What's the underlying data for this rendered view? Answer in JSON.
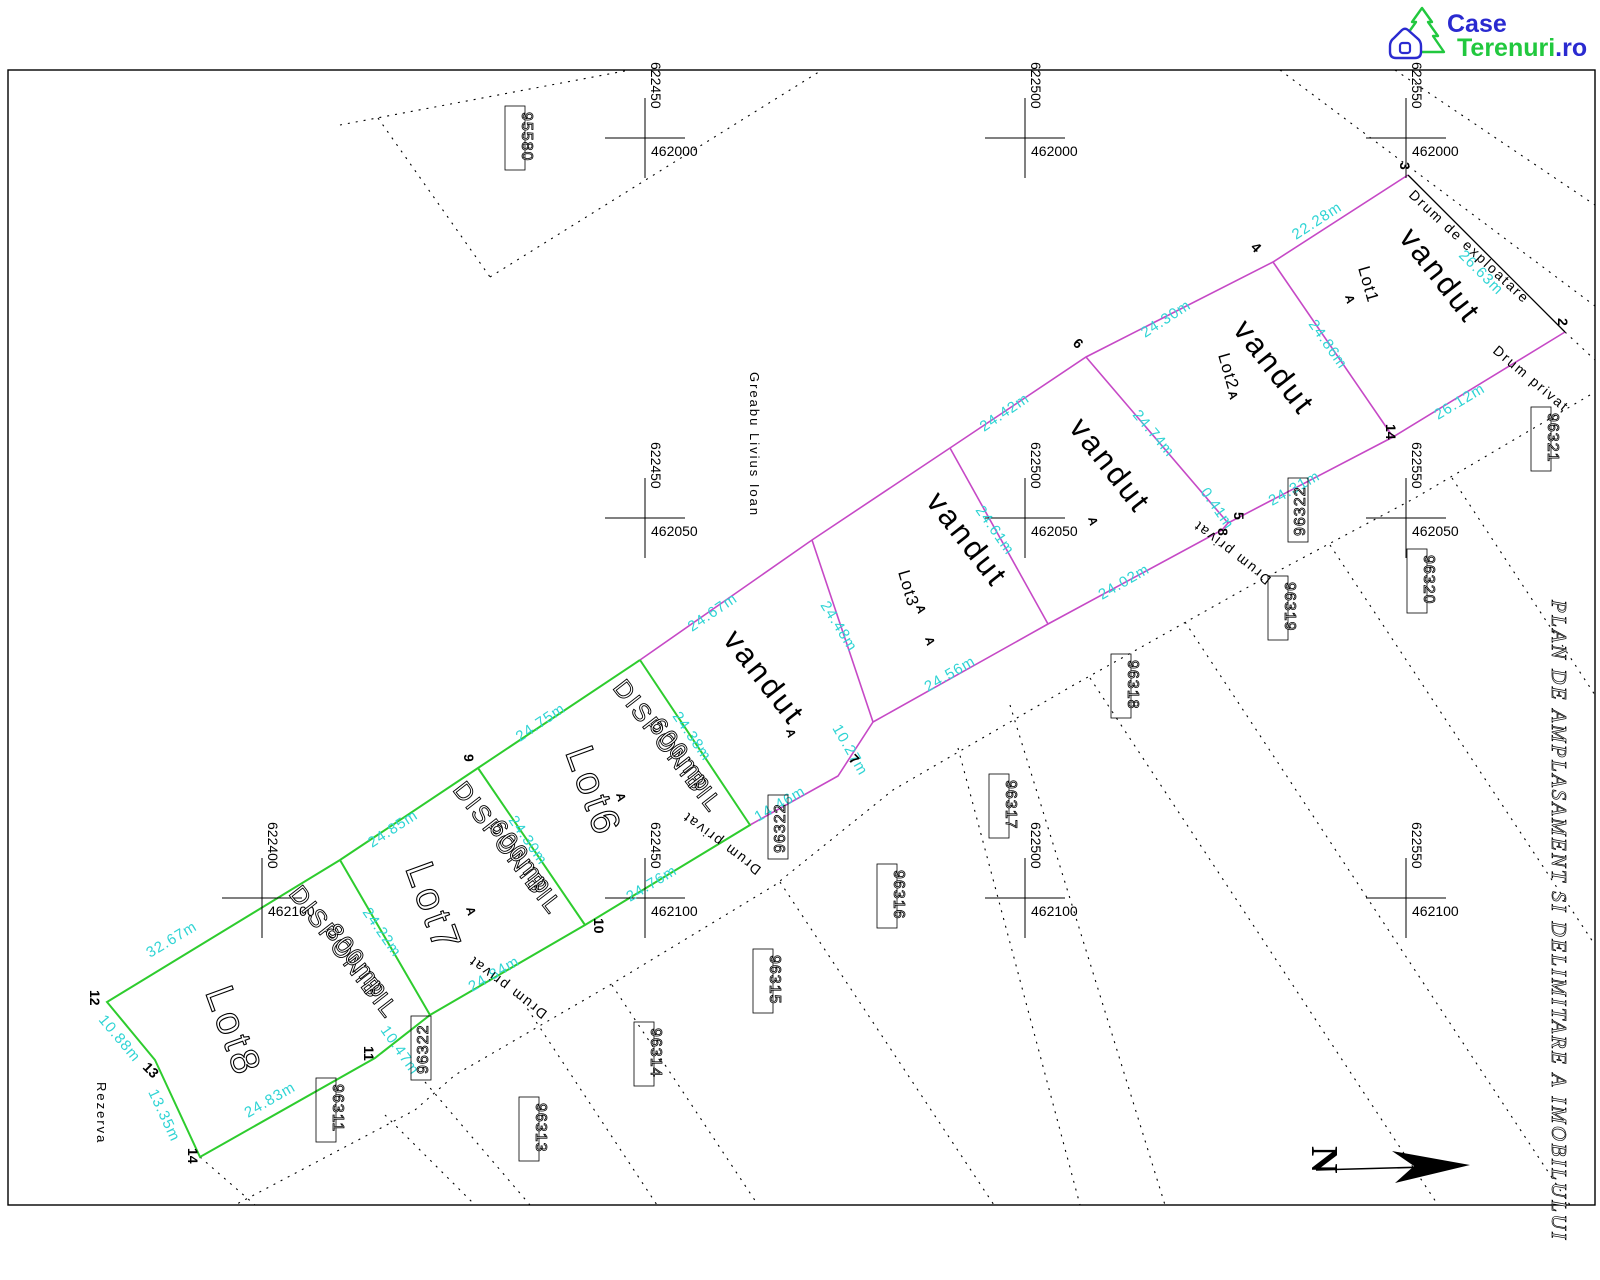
{
  "logo": {
    "case": "Case",
    "terenuri": "Terenuri",
    "ro": ".ro"
  },
  "title": "PLAN DE AMPLASAMENT SI DELIMITARE A IMOBILULUI",
  "neighbor_owner": "Greabu Livius Ioan",
  "reserve_label": "Rezerva",
  "north_letter": "N",
  "marker": "A",
  "roads": {
    "exploatare": "Drum de exploatare",
    "privat": "Drum privat"
  },
  "lots": [
    {
      "name": "Lot1",
      "status": "vandut"
    },
    {
      "name": "Lot2",
      "status": "vandut"
    },
    {
      "name": "",
      "status": "vandut"
    },
    {
      "name": "Lot3",
      "status": "vandut"
    },
    {
      "name": "",
      "status": "vandut"
    },
    {
      "name": "Lot6",
      "status": "DISPONIBIL",
      "area": "600mp"
    },
    {
      "name": "Lot7",
      "status": "DISPONIBIL",
      "area": "600mp"
    },
    {
      "name": "Lot8",
      "status": "DISPONIBIL",
      "area": "800mp"
    }
  ],
  "dims": [
    "26.63m",
    "22.28m",
    "26.12m",
    "24.86m",
    "24.30m",
    "24.74m",
    "24.31m",
    "0.41m",
    "24.42m",
    "24.61m",
    "24.02m",
    "24.56m",
    "24.48m",
    "24.67m",
    "10.27m",
    "14.46m",
    "24.38m",
    "24.75m",
    "24.76m",
    "24.30m",
    "24.85m",
    "24.84m",
    "24.22m",
    "10.47m",
    "24.83m",
    "32.67m",
    "10.88m",
    "13.35m"
  ],
  "parcels": {
    "p95580": "95580",
    "p96311": "96311",
    "p96313": "96313",
    "p96314": "96314",
    "p96315": "96315",
    "p96316": "96316",
    "p96317": "96317",
    "p96318": "96318",
    "p96319": "96319",
    "p96320": "96320",
    "p96321": "96321",
    "p96322": "96322"
  },
  "grid": {
    "eastings": [
      "622400",
      "622450",
      "622500",
      "622550"
    ],
    "northings": [
      "462000",
      "462050",
      "462100"
    ]
  },
  "points": [
    "2",
    "3",
    "4",
    "5",
    "6",
    "7",
    "8",
    "9",
    "10",
    "11",
    "12",
    "13",
    "14"
  ],
  "colors": {
    "sold": "#c649c6",
    "available": "#2ecc2e",
    "dimension": "#2fd4d4",
    "logo_blue": "#2a2ad0",
    "logo_green": "#21c83e"
  }
}
